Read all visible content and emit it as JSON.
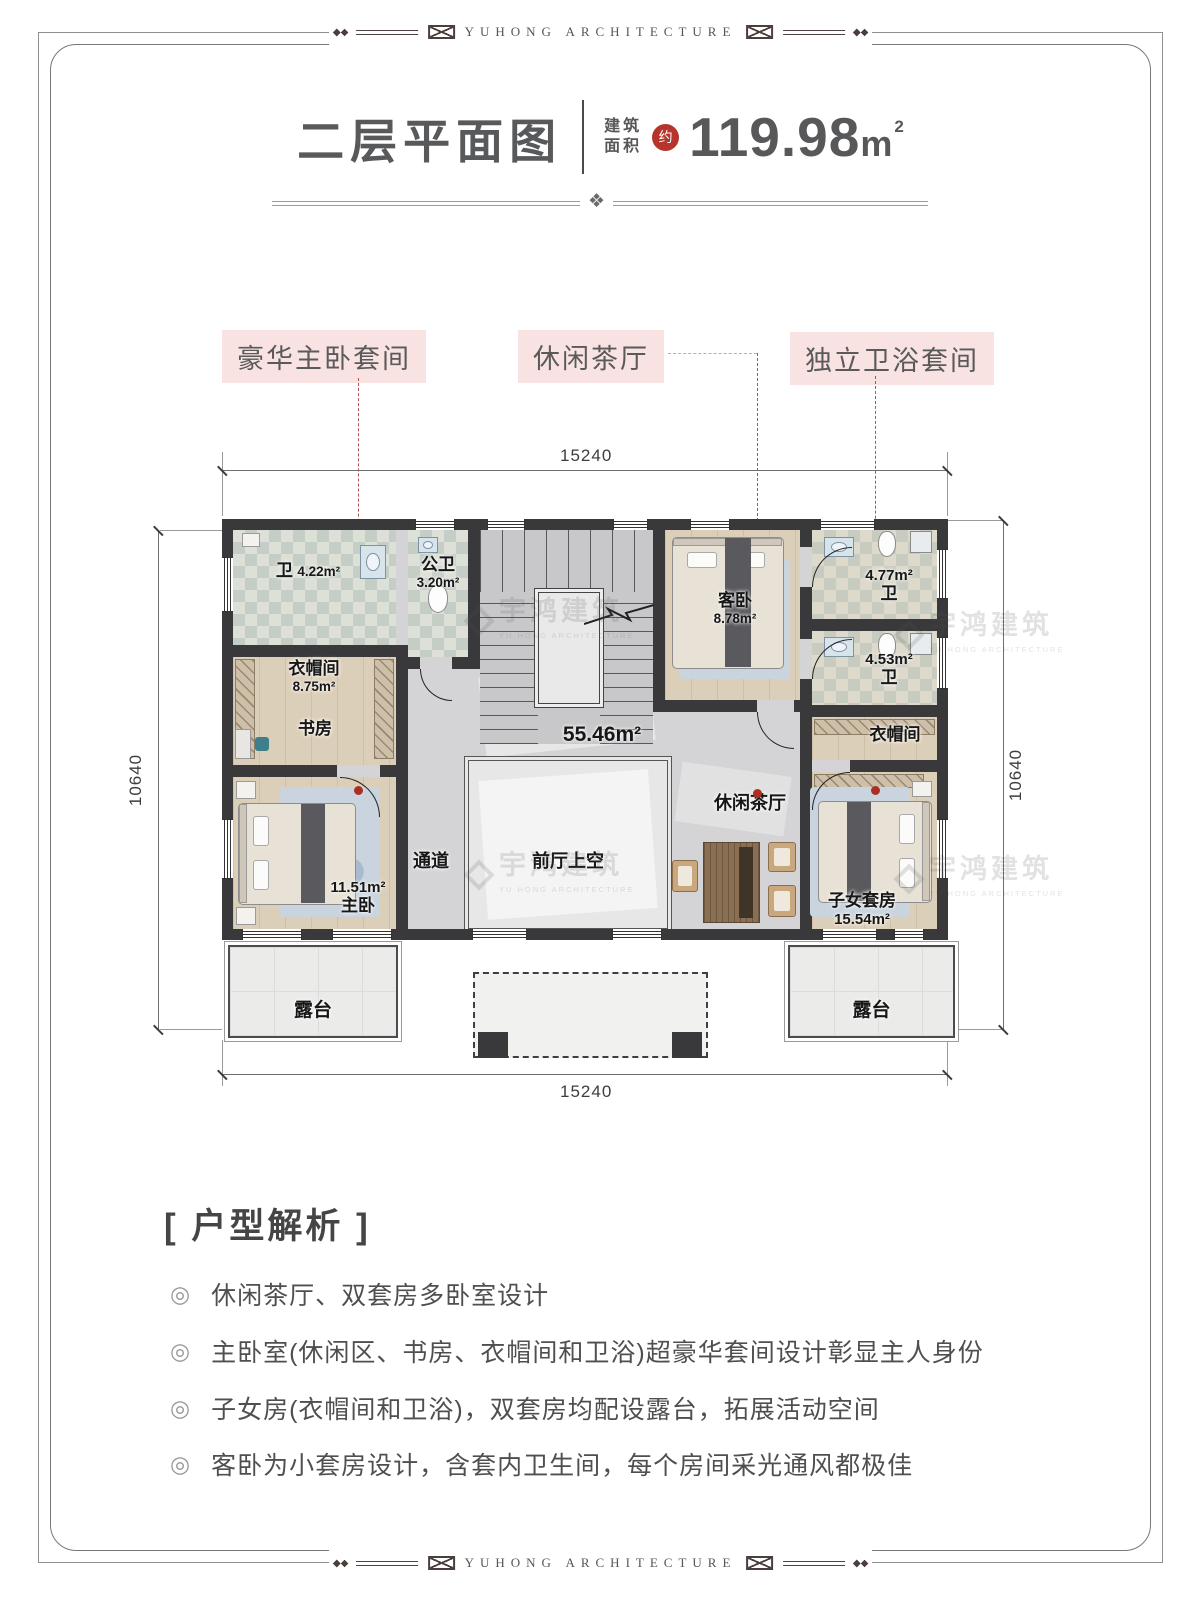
{
  "frame": {
    "banner_text": "YUHONG ARCHITECTURE"
  },
  "icons": {
    "divider": "❖",
    "bullet": "◎"
  },
  "header": {
    "title": "二层平面图",
    "area_label_top": "建筑",
    "area_label_bottom": "面积",
    "approx_badge": "约",
    "area_value": "119.98",
    "area_unit": "m",
    "area_sup": "2"
  },
  "callouts": {
    "master_suite": "豪华主卧套间",
    "tea_lounge": "休闲茶厅",
    "bath_suite": "独立卫浴套间"
  },
  "dimensions": {
    "top": "15240",
    "bottom": "15240",
    "left": "10640",
    "right": "10640"
  },
  "rooms": {
    "bath_top_left": {
      "name": "卫",
      "area": "4.22m²"
    },
    "public_bath": {
      "name": "公卫",
      "area": "3.20m²"
    },
    "closet_left": {
      "name": "衣帽间",
      "area": "8.75m²"
    },
    "study": {
      "name": "书房"
    },
    "guest_bedroom": {
      "name": "客卧",
      "area": "8.78m²"
    },
    "bath_right_upper": {
      "name": "卫",
      "area": "4.77m²"
    },
    "bath_right_lower": {
      "name": "卫",
      "area": "4.53m²"
    },
    "closet_right": {
      "name": "衣帽间"
    },
    "hall": {
      "area": "55.46m²"
    },
    "corridor": {
      "name": "通道"
    },
    "foyer_void": {
      "name": "前厅上空"
    },
    "tea_lounge": {
      "name": "休闲茶厅"
    },
    "master_bedroom": {
      "name": "主卧",
      "area": "11.51m²"
    },
    "children_suite": {
      "name": "子女套房",
      "area": "15.54m²"
    },
    "terrace_left": {
      "name": "露台"
    },
    "terrace_right": {
      "name": "露台"
    }
  },
  "watermark": {
    "cn": "宇鸿建筑",
    "en": "YU HONG ARCHITECTURE"
  },
  "analysis": {
    "title": "[ 户型解析 ]",
    "items": [
      "休闲茶厅、双套房多卧室设计",
      "主卧室(休闲区、书房、衣帽间和卫浴)超豪华套间设计彰显主人身份",
      "子女房(衣帽间和卫浴)，双套房均配设露台，拓展活动空间",
      "客卧为小套房设计，含套内卫生间，每个房间采光通风都极佳"
    ]
  }
}
